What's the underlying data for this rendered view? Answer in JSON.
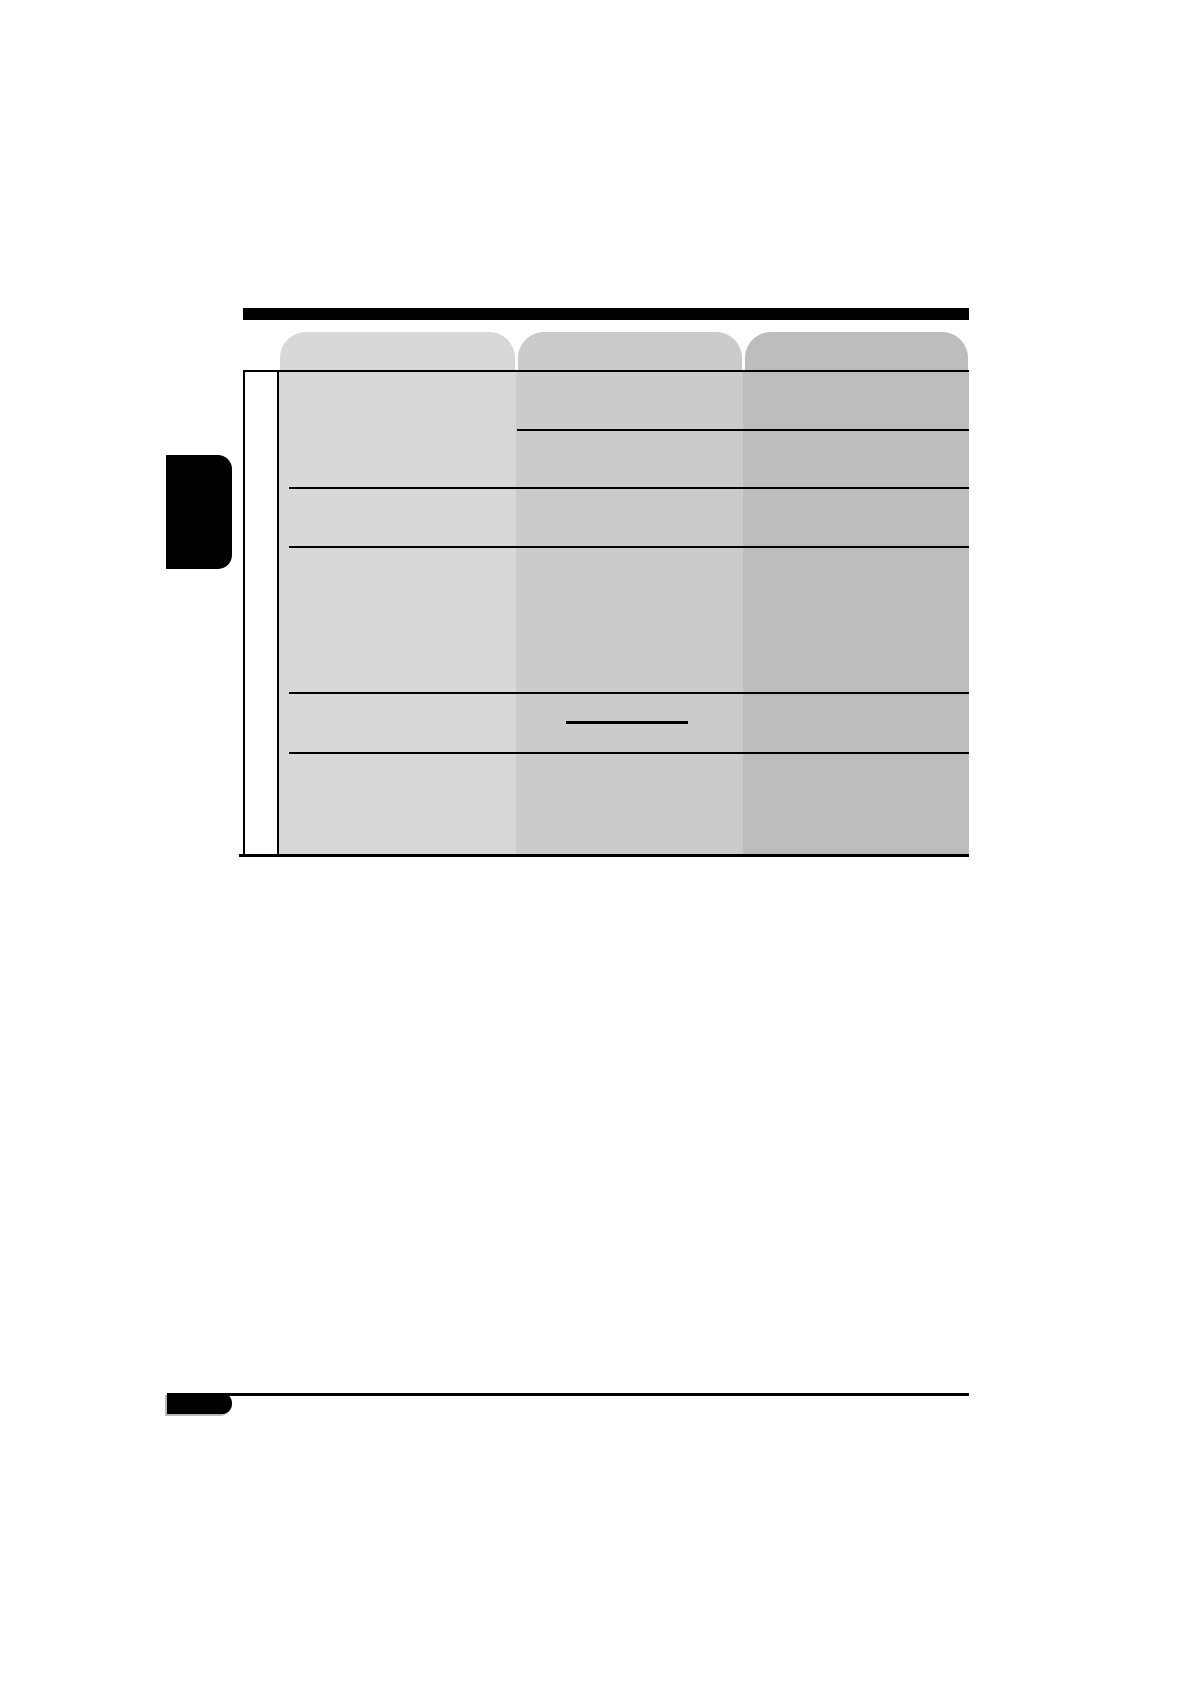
{
  "page": {
    "kind": "printed-manual-page",
    "background": "#ffffff",
    "visible_text": []
  },
  "colors": {
    "ink": "#000000",
    "paper": "#ffffff",
    "column_1_fill": "#d8d8d8",
    "column_2_fill": "#cbcbcb",
    "column_3_fill": "#bdbdbd",
    "page_tab_edge": "#b9b9b9"
  },
  "table": {
    "column_count": 3,
    "columns": [
      {
        "id": "column-1",
        "fill": "#d8d8d8",
        "tab_label": ""
      },
      {
        "id": "column-2",
        "fill": "#cbcbcb",
        "tab_label": ""
      },
      {
        "id": "column-3",
        "fill": "#bdbdbd",
        "tab_label": ""
      }
    ],
    "left_gutter_column": {
      "fill": "#ffffff",
      "label": ""
    },
    "full_width_row_dividers": 4,
    "partial_row_dividers_cols_2_3": 1,
    "cell_underline_marks": 1,
    "cells_text": []
  },
  "header": {
    "section_bar_text": ""
  },
  "sidebar_tab": {
    "label": ""
  },
  "footer": {
    "page_number": ""
  }
}
